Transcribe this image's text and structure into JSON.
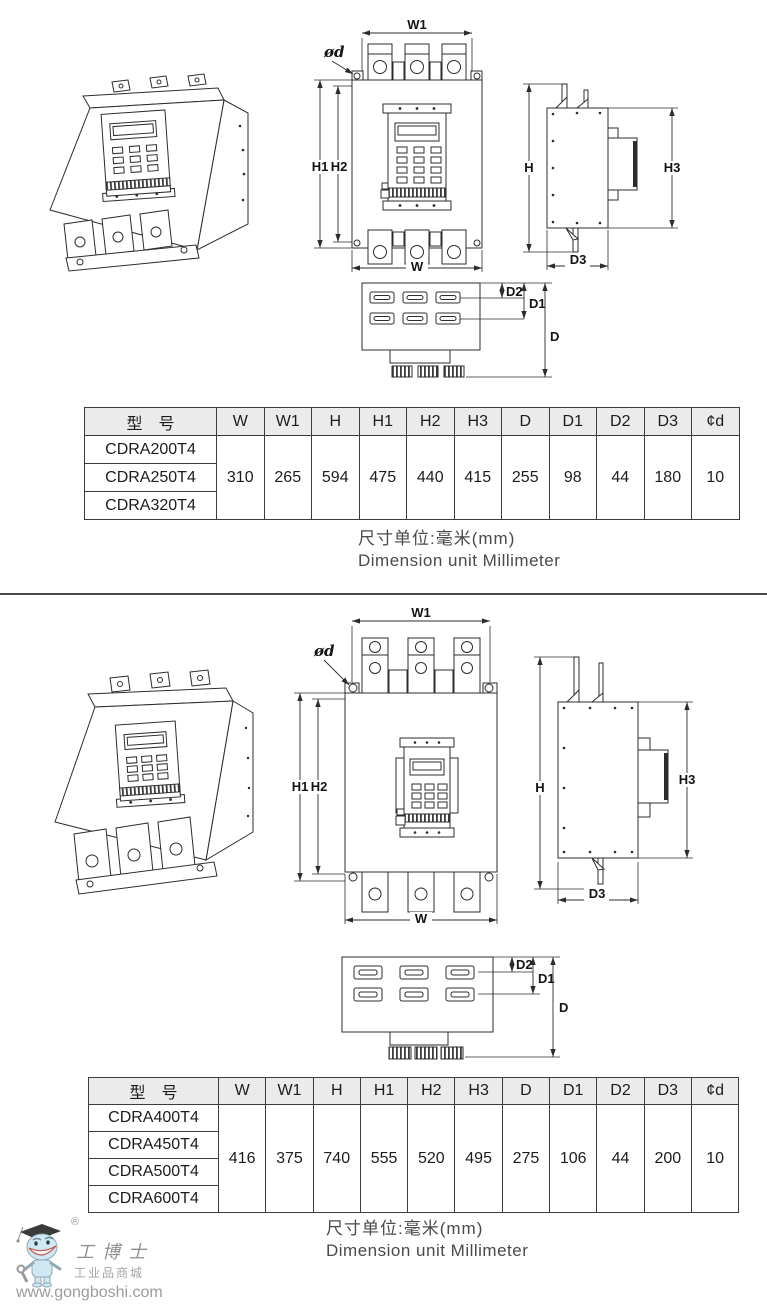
{
  "dim_labels": {
    "w1": "W1",
    "phi_d": "ød",
    "h1": "H1",
    "h2": "H2",
    "w": "W",
    "h": "H",
    "h3": "H3",
    "d3": "D3",
    "d2": "D2",
    "d1": "D1",
    "d": "D"
  },
  "table_small": {
    "col_headers": [
      "型　号",
      "W",
      "W1",
      "H",
      "H1",
      "H2",
      "H3",
      "D",
      "D1",
      "D2",
      "D3",
      "¢d"
    ],
    "models": [
      "CDRA200T4",
      "CDRA250T4",
      "CDRA320T4"
    ],
    "shared_values": [
      "310",
      "265",
      "594",
      "475",
      "440",
      "415",
      "255",
      "98",
      "44",
      "180",
      "10"
    ]
  },
  "table_large": {
    "col_headers": [
      "型　号",
      "W",
      "W1",
      "H",
      "H1",
      "H2",
      "H3",
      "D",
      "D1",
      "D2",
      "D3",
      "¢d"
    ],
    "models": [
      "CDRA400T4",
      "CDRA450T4",
      "CDRA500T4",
      "CDRA600T4"
    ],
    "shared_values": [
      "416",
      "375",
      "740",
      "555",
      "520",
      "495",
      "275",
      "106",
      "44",
      "200",
      "10"
    ]
  },
  "unit_note": {
    "cn": "尺寸单位:毫米(mm)",
    "en": "Dimension unit Millimeter"
  },
  "watermark": {
    "registered_mark": "®",
    "brand": "工博士",
    "tagline": "工业品商城",
    "url": "www.gongboshi.com"
  }
}
